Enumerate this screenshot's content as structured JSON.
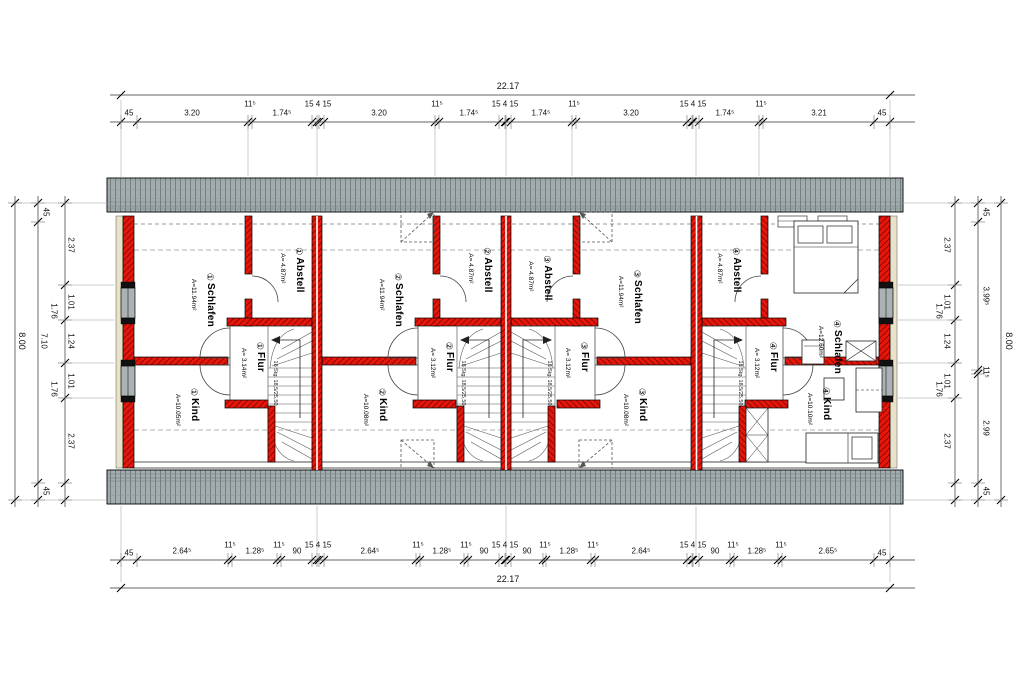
{
  "drawing": {
    "dims": {
      "top": {
        "total": "22.17",
        "segments": [
          "45",
          "3.20",
          "11⁵",
          "1.74⁵",
          "15 4 15",
          "3.20",
          "11⁵",
          "1.74⁵",
          "15 4 15",
          "1.74⁵",
          "11⁵",
          "3.20",
          "15 4 15",
          "1.74⁵",
          "11⁵",
          "3.21",
          "45"
        ]
      },
      "bottom": {
        "total": "22.17",
        "segments": [
          "45",
          "2.64⁵",
          "11⁵",
          "1.28⁵",
          "11⁵",
          "90",
          "15 4 15",
          "2.64⁵",
          "11⁵",
          "1.28⁵",
          "11⁵",
          "90",
          "15 4 15",
          "90",
          "11⁵",
          "1.28⁵",
          "11⁵",
          "2.64⁵",
          "15 4 15",
          "90",
          "11⁵",
          "1.28⁵",
          "11⁵",
          "2.65⁵",
          "45"
        ]
      },
      "left": {
        "total": "8.00",
        "chain": [
          "45",
          "7.10",
          "45"
        ],
        "offsets": [
          "1.76",
          "1.76"
        ],
        "inner": [
          "2.37",
          "1.01",
          "1.24",
          "1.01",
          "2.37"
        ]
      },
      "right": {
        "total": "8.00",
        "chain": [
          "45",
          "3.99⁵",
          "11⁵",
          "2.99",
          "45"
        ],
        "offsets": [
          "1.76",
          "1.76"
        ],
        "inner": [
          "2.37",
          "1.01",
          "1.24",
          "1.01",
          "2.37"
        ]
      }
    },
    "stair_label": "18 Stg. 18,5/25,50",
    "units": [
      {
        "id": "①",
        "schlafen": "Schlafen",
        "schlafen_area": "A=11.94m²",
        "abstell": "Abstell",
        "abstell_area": "A= 4.87m²",
        "flur": "Flur",
        "flur_area": "A= 3.14m²",
        "kind": "Kind",
        "kind_area": "A=10.05m²"
      },
      {
        "id": "②",
        "schlafen": "Schlafen",
        "schlafen_area": "A=11.94m²",
        "abstell": "Abstell",
        "abstell_area": "A= 4.87m²",
        "flur": "Flur",
        "flur_area": "A= 3.12m²",
        "kind": "Kind",
        "kind_area": "A=10.08m²"
      },
      {
        "id": "③",
        "schlafen": "Schlafen",
        "schlafen_area": "A=11.94m²",
        "abstell": "Abstell",
        "abstell_area": "A= 4.87m²",
        "flur": "Flur",
        "flur_area": "A= 3.12m²",
        "kind": "Kind",
        "kind_area": "A=10.08m²"
      },
      {
        "id": "④",
        "schlafen": "Schlafen",
        "schlafen_area": "A=12.60m²",
        "abstell": "Abstell",
        "abstell_area": "A= 4.87m²",
        "flur": "Flur",
        "flur_area": "A= 3.12m²",
        "kind": "Kind",
        "kind_area": "A=10.10m²"
      }
    ]
  }
}
